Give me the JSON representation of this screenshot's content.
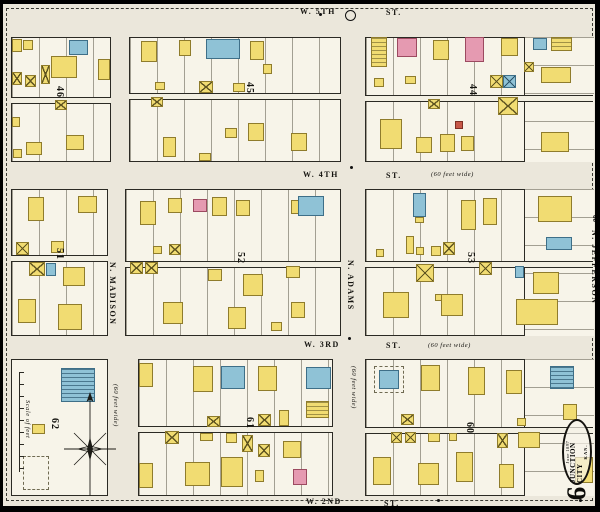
{
  "map_title": "Sanborn fire insurance map, Junction City, Kansas, sheet 9",
  "sheet_number": "9",
  "stamp": {
    "date": "June 1897",
    "city": "JUNCTION CITY",
    "state": "KAN."
  },
  "streets": {
    "fifth": {
      "name": "W. 5TH",
      "type": "ST."
    },
    "fourth": {
      "name": "W. 4TH",
      "type": "ST.",
      "note": "(60 feet wide)"
    },
    "third": {
      "name": "W. 3RD",
      "type": "ST.",
      "note": "(60 feet wide)"
    },
    "second": {
      "name": "W. 2ND",
      "type": "ST."
    },
    "madison": {
      "name": "N. MADISON",
      "note": "(60 feet wide)"
    },
    "adams": {
      "name": "N. ADAMS",
      "note": "(60 feet wide)"
    },
    "jefferson": {
      "name": "N. JEFFERSON",
      "width_number": "60"
    }
  },
  "scale": {
    "label": "Scale of feet"
  },
  "legend_colors": {
    "frame_wood": "#f1dc72",
    "brick": "#e59ab1",
    "stone_special": "#8fc2d6",
    "adobe_red": "#c75848",
    "paper": "#ebe7db"
  },
  "dots": [
    [
      347,
      162
    ],
    [
      345,
      333
    ],
    [
      434,
      495
    ],
    [
      576,
      495
    ],
    [
      316,
      9
    ]
  ],
  "blocks": [
    {
      "number": "46",
      "x": 8,
      "y": 33,
      "w": 100,
      "h": 125,
      "alley": 59,
      "nx": 62,
      "ny": 82,
      "lots": true,
      "buildings": [
        [
          9,
          35,
          10,
          13,
          "y"
        ],
        [
          20,
          36,
          10,
          10,
          "y"
        ],
        [
          48,
          52,
          26,
          22,
          "y"
        ],
        [
          66,
          36,
          19,
          15,
          "b"
        ],
        [
          95,
          55,
          12,
          21,
          "y"
        ],
        [
          9,
          68,
          10,
          13,
          "yx"
        ],
        [
          22,
          71,
          11,
          12,
          "yx"
        ],
        [
          38,
          61,
          9,
          19,
          "yx"
        ],
        [
          52,
          96,
          12,
          10,
          "yx"
        ],
        [
          9,
          113,
          8,
          10,
          "y"
        ],
        [
          23,
          138,
          16,
          13,
          "y"
        ],
        [
          63,
          131,
          18,
          15,
          "y"
        ],
        [
          10,
          145,
          9,
          9,
          "y"
        ]
      ]
    },
    {
      "number": "45",
      "x": 126,
      "y": 33,
      "w": 212,
      "h": 125,
      "alley": 55,
      "nx": 252,
      "ny": 78,
      "lots": true,
      "buildings": [
        [
          138,
          37,
          16,
          21,
          "y"
        ],
        [
          176,
          36,
          12,
          16,
          "y"
        ],
        [
          203,
          35,
          34,
          20,
          "b"
        ],
        [
          247,
          37,
          14,
          19,
          "y"
        ],
        [
          152,
          78,
          10,
          8,
          "y"
        ],
        [
          196,
          77,
          14,
          12,
          "yx"
        ],
        [
          230,
          79,
          12,
          9,
          "y"
        ],
        [
          260,
          60,
          9,
          10,
          "y"
        ],
        [
          148,
          93,
          12,
          10,
          "yx"
        ],
        [
          160,
          133,
          13,
          20,
          "y"
        ],
        [
          222,
          124,
          12,
          10,
          "y"
        ],
        [
          245,
          119,
          16,
          18,
          "y"
        ],
        [
          288,
          129,
          16,
          18,
          "y"
        ],
        [
          196,
          149,
          12,
          8,
          "y"
        ]
      ]
    },
    {
      "number": "44",
      "x": 362,
      "y": 33,
      "w": 228,
      "h": 125,
      "alley": 57,
      "nx": 475,
      "ny": 80,
      "lots": true,
      "hsec": [
        158,
        70
      ],
      "buildings": [
        [
          368,
          33,
          16,
          30,
          "ym"
        ],
        [
          394,
          34,
          20,
          19,
          "p"
        ],
        [
          430,
          36,
          16,
          20,
          "y"
        ],
        [
          462,
          33,
          19,
          25,
          "p"
        ],
        [
          498,
          34,
          17,
          18,
          "y"
        ],
        [
          530,
          34,
          14,
          12,
          "b"
        ],
        [
          548,
          33,
          21,
          14,
          "ym"
        ],
        [
          538,
          63,
          30,
          16,
          "y"
        ],
        [
          521,
          58,
          10,
          10,
          "yx"
        ],
        [
          371,
          74,
          10,
          9,
          "y"
        ],
        [
          402,
          72,
          11,
          8,
          "y"
        ],
        [
          487,
          71,
          13,
          13,
          "yx"
        ],
        [
          500,
          71,
          13,
          13,
          "bx"
        ],
        [
          425,
          95,
          12,
          10,
          "yx"
        ],
        [
          495,
          93,
          20,
          18,
          "yx"
        ],
        [
          452,
          117,
          8,
          8,
          "r"
        ],
        [
          377,
          115,
          22,
          30,
          "y"
        ],
        [
          413,
          133,
          16,
          16,
          "y"
        ],
        [
          437,
          130,
          15,
          18,
          "y"
        ],
        [
          458,
          132,
          13,
          15,
          "y"
        ],
        [
          538,
          128,
          28,
          20,
          "y"
        ]
      ]
    },
    {
      "number": "51",
      "x": 8,
      "y": 185,
      "w": 97,
      "h": 147,
      "alley": 65,
      "nx": 62,
      "ny": 244,
      "lots": true,
      "buildings": [
        [
          25,
          193,
          16,
          24,
          "y"
        ],
        [
          75,
          192,
          19,
          17,
          "y"
        ],
        [
          13,
          238,
          13,
          13,
          "yx"
        ],
        [
          48,
          237,
          13,
          12,
          "y"
        ],
        [
          26,
          258,
          16,
          14,
          "yx"
        ],
        [
          43,
          259,
          10,
          13,
          "b"
        ],
        [
          60,
          263,
          22,
          19,
          "y"
        ],
        [
          15,
          295,
          18,
          24,
          "y"
        ],
        [
          55,
          300,
          24,
          26,
          "y"
        ]
      ]
    },
    {
      "number": "52",
      "x": 122,
      "y": 185,
      "w": 216,
      "h": 147,
      "alley": 71,
      "nx": 243,
      "ny": 248,
      "lots": true,
      "buildings": [
        [
          137,
          197,
          16,
          24,
          "y"
        ],
        [
          165,
          194,
          14,
          15,
          "y"
        ],
        [
          190,
          195,
          14,
          13,
          "p"
        ],
        [
          209,
          193,
          15,
          19,
          "y"
        ],
        [
          233,
          196,
          14,
          16,
          "y"
        ],
        [
          288,
          196,
          8,
          14,
          "y"
        ],
        [
          295,
          192,
          26,
          20,
          "b"
        ],
        [
          150,
          242,
          9,
          8,
          "y"
        ],
        [
          166,
          240,
          12,
          11,
          "yx"
        ],
        [
          127,
          258,
          13,
          12,
          "yx"
        ],
        [
          142,
          258,
          13,
          12,
          "yx"
        ],
        [
          205,
          265,
          14,
          12,
          "y"
        ],
        [
          240,
          270,
          20,
          22,
          "y"
        ],
        [
          283,
          262,
          14,
          12,
          "y"
        ],
        [
          160,
          298,
          20,
          22,
          "y"
        ],
        [
          225,
          303,
          18,
          22,
          "y"
        ],
        [
          288,
          298,
          14,
          16,
          "y"
        ],
        [
          268,
          318,
          11,
          9,
          "y"
        ]
      ]
    },
    {
      "number": "53",
      "x": 362,
      "y": 185,
      "w": 228,
      "h": 147,
      "alley": 71,
      "nx": 473,
      "ny": 248,
      "lots": true,
      "hsec": [
        158,
        70
      ],
      "buildings": [
        [
          410,
          189,
          13,
          24,
          "b"
        ],
        [
          412,
          213,
          9,
          6,
          "y"
        ],
        [
          458,
          196,
          15,
          30,
          "y"
        ],
        [
          480,
          194,
          14,
          27,
          "y"
        ],
        [
          535,
          192,
          34,
          26,
          "y"
        ],
        [
          543,
          233,
          26,
          13,
          "b"
        ],
        [
          373,
          245,
          8,
          8,
          "y"
        ],
        [
          403,
          232,
          8,
          18,
          "y"
        ],
        [
          413,
          243,
          8,
          8,
          "y"
        ],
        [
          428,
          242,
          10,
          10,
          "y"
        ],
        [
          440,
          238,
          12,
          13,
          "yx"
        ],
        [
          413,
          260,
          18,
          18,
          "yx"
        ],
        [
          476,
          258,
          13,
          13,
          "yx"
        ],
        [
          512,
          262,
          9,
          12,
          "b"
        ],
        [
          432,
          290,
          7,
          7,
          "y"
        ],
        [
          380,
          288,
          26,
          26,
          "y"
        ],
        [
          438,
          290,
          22,
          22,
          "y"
        ],
        [
          530,
          268,
          26,
          22,
          "y"
        ],
        [
          513,
          295,
          42,
          26,
          "y"
        ]
      ]
    },
    {
      "number": "62",
      "x": 8,
      "y": 355,
      "w": 97,
      "h": 137,
      "nx": 57,
      "ny": 414,
      "lots": false,
      "buildings": [
        [
          58,
          364,
          34,
          34,
          "bm"
        ],
        [
          29,
          420,
          13,
          10,
          "y"
        ],
        [
          20,
          452,
          26,
          34,
          "od"
        ]
      ]
    },
    {
      "number": "61",
      "x": 135,
      "y": 355,
      "w": 195,
      "h": 137,
      "alley": 66,
      "nx": 252,
      "ny": 413,
      "lots": true,
      "buildings": [
        [
          136,
          359,
          14,
          24,
          "y"
        ],
        [
          190,
          362,
          20,
          26,
          "y"
        ],
        [
          218,
          362,
          24,
          23,
          "b"
        ],
        [
          255,
          362,
          19,
          25,
          "y"
        ],
        [
          303,
          363,
          25,
          22,
          "b"
        ],
        [
          303,
          397,
          23,
          17,
          "ym"
        ],
        [
          204,
          412,
          13,
          11,
          "yx"
        ],
        [
          255,
          410,
          13,
          12,
          "yx"
        ],
        [
          276,
          406,
          10,
          16,
          "y"
        ],
        [
          162,
          427,
          14,
          13,
          "yx"
        ],
        [
          197,
          429,
          13,
          8,
          "y"
        ],
        [
          223,
          429,
          11,
          10,
          "y"
        ],
        [
          239,
          431,
          11,
          17,
          "yx"
        ],
        [
          255,
          440,
          12,
          13,
          "yx"
        ],
        [
          136,
          459,
          14,
          25,
          "y"
        ],
        [
          182,
          458,
          25,
          24,
          "y"
        ],
        [
          218,
          453,
          22,
          30,
          "y"
        ],
        [
          252,
          466,
          9,
          12,
          "y"
        ],
        [
          280,
          437,
          18,
          17,
          "y"
        ],
        [
          290,
          465,
          14,
          16,
          "p"
        ]
      ]
    },
    {
      "number": "60",
      "x": 362,
      "y": 355,
      "w": 228,
      "h": 137,
      "alley": 67,
      "nx": 472,
      "ny": 418,
      "lots": true,
      "hsec": [
        158,
        70
      ],
      "buildings": [
        [
          371,
          362,
          30,
          27,
          "od"
        ],
        [
          376,
          366,
          20,
          19,
          "b"
        ],
        [
          418,
          361,
          19,
          26,
          "y"
        ],
        [
          465,
          363,
          17,
          28,
          "y"
        ],
        [
          503,
          366,
          16,
          24,
          "y"
        ],
        [
          547,
          362,
          24,
          23,
          "bm"
        ],
        [
          560,
          400,
          14,
          16,
          "y"
        ],
        [
          398,
          410,
          13,
          11,
          "yx"
        ],
        [
          514,
          414,
          9,
          8,
          "y"
        ],
        [
          388,
          428,
          11,
          11,
          "yx"
        ],
        [
          402,
          428,
          11,
          11,
          "yx"
        ],
        [
          425,
          429,
          12,
          9,
          "y"
        ],
        [
          446,
          429,
          8,
          8,
          "y"
        ],
        [
          494,
          429,
          11,
          15,
          "yx"
        ],
        [
          515,
          428,
          22,
          16,
          "y"
        ],
        [
          370,
          453,
          18,
          28,
          "y"
        ],
        [
          415,
          459,
          21,
          22,
          "y"
        ],
        [
          453,
          448,
          17,
          30,
          "y"
        ],
        [
          496,
          460,
          15,
          24,
          "y"
        ],
        [
          572,
          453,
          18,
          26,
          "y"
        ]
      ]
    }
  ]
}
